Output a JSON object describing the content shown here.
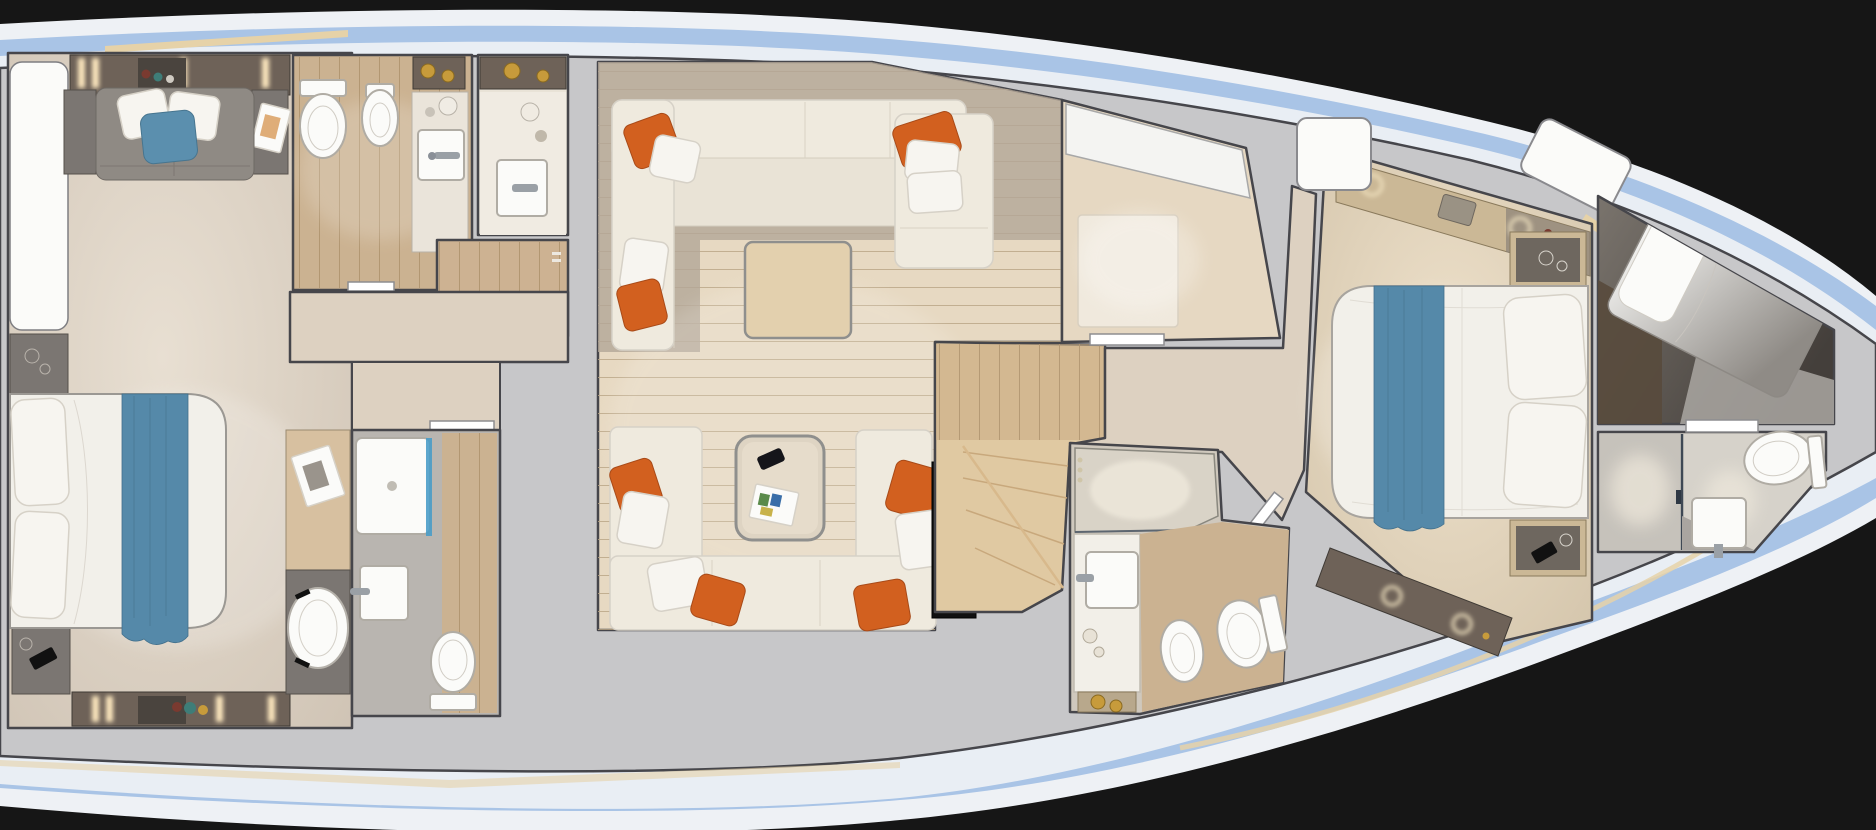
{
  "meta": {
    "kind": "yacht-interior-floor-plan-rendering",
    "view": "top-down",
    "orientation": "bow-right-stern-left",
    "visible_text": "none"
  },
  "palette": {
    "background": "#161616",
    "hull_white": "#eef1f5",
    "hull_blue": "#a9c4e6",
    "hull_inner_white": "#e9eef4",
    "deck": "#c7c7c9",
    "wall_line": "#46464b",
    "trim_tan": "#e6d2a8",
    "floor_beige": "#ddd1c1",
    "floor_wood": "#e7d9c2",
    "floor_wood_dark": "#cbb291",
    "floor_gray": "#b9b5b0",
    "taupe_shadow": "#b3a697",
    "sofa_cream": "#efeade",
    "sofa_cream_seat": "#e9e3d6",
    "sofa_gray": "#8f8a84",
    "pillow_orange": "#d2601f",
    "pillow_white": "#f7f5f0",
    "pillow_blue": "#5b8fae",
    "bed_white": "#f2f0ea",
    "throw_blue": "#5589a9",
    "fixture_white": "#fbfbf9",
    "cabinet_dark": "#6e6258",
    "cabinet_wood": "#cbb896",
    "desk_wood": "#d7c0a0",
    "nightstand_gray": "#7b7672",
    "black_unit": "#101010",
    "accent_gold": "#c79b3b",
    "light_glow": "#ffe9c0",
    "wood_slat": "#cdb292",
    "door_white": "#ffffff",
    "counter_white": "#f4f4f2",
    "stair_wood": "#e0c9a2",
    "landing_wood": "#c9ad86",
    "rug_light": "#f0e9dd",
    "table_wood": "#e3d0ae",
    "shower_glass_blue": "#4a9cc8",
    "crew_floor": "#584a3c",
    "light_wall": "#aaa7a2"
  },
  "rooms": [
    {
      "id": "master-cabin",
      "label": "master cabin (aft)",
      "furniture": [
        "double-bed-blue-throw",
        "headboard-pillows",
        "sofa-with-pillows",
        "side-tables",
        "nightstands",
        "wardrobe-strip",
        "vanity-desk",
        "chair",
        "hull-window-panel"
      ]
    },
    {
      "id": "aft-bathroom",
      "label": "aft bathroom",
      "furniture": [
        "toilet",
        "bidet",
        "vanity-sink",
        "vessel-bowl-counter"
      ]
    },
    {
      "id": "shower-room",
      "label": "shower room",
      "furniture": [
        "vessel-bowl-counter",
        "square-sink"
      ]
    },
    {
      "id": "dressing-area",
      "label": "dressing area",
      "furniture": [
        "wood-slat-floor",
        "drawer-handles"
      ]
    },
    {
      "id": "aft-corridor",
      "label": "corridor",
      "furniture": [
        "door-leaf"
      ]
    },
    {
      "id": "guest-bathroom-aft",
      "label": "guest bathroom",
      "furniture": [
        "shower-tray",
        "square-sink",
        "toilet"
      ]
    },
    {
      "id": "salon",
      "label": "main salon",
      "furniture": [
        "l-sofa-top",
        "chaise",
        "square-side-table",
        "u-sofa-bottom",
        "coffee-table",
        "phone",
        "magazine",
        "orange-pillows",
        "white-pillows",
        "sideboard",
        "tv-cabinet"
      ]
    },
    {
      "id": "stairwell",
      "label": "stairs to lower deck",
      "furniture": [
        "winder-steps",
        "landing"
      ]
    },
    {
      "id": "galley",
      "label": "galley",
      "furniture": [
        "white-counter",
        "rug",
        "door-leaf"
      ]
    },
    {
      "id": "fore-corridor",
      "label": "foyer corridor",
      "furniture": [
        "door-leaf"
      ]
    },
    {
      "id": "mid-bathroom",
      "label": "forward guest bathroom",
      "furniture": [
        "shower",
        "vanity-sink",
        "bidet",
        "toilet",
        "vessel-bowl-shelf"
      ]
    },
    {
      "id": "vip-cabin",
      "label": "VIP cabin (forward)",
      "furniture": [
        "double-bed-blue-throw",
        "pillows",
        "nightstands",
        "wardrobe-strips",
        "skylight-hatches"
      ]
    },
    {
      "id": "crew-cabin",
      "label": "bow cabin",
      "furniture": [
        "diagonal-berth",
        "pillow"
      ]
    },
    {
      "id": "bow-bathroom",
      "label": "bow bathroom",
      "furniture": [
        "shower",
        "square-sink",
        "toilet",
        "door-leaf"
      ]
    }
  ],
  "hull": {
    "bands_outside_in": [
      "white",
      "blue",
      "white",
      "gray-deck"
    ],
    "accents": [
      "tan-trim-strips"
    ],
    "background": "black"
  }
}
